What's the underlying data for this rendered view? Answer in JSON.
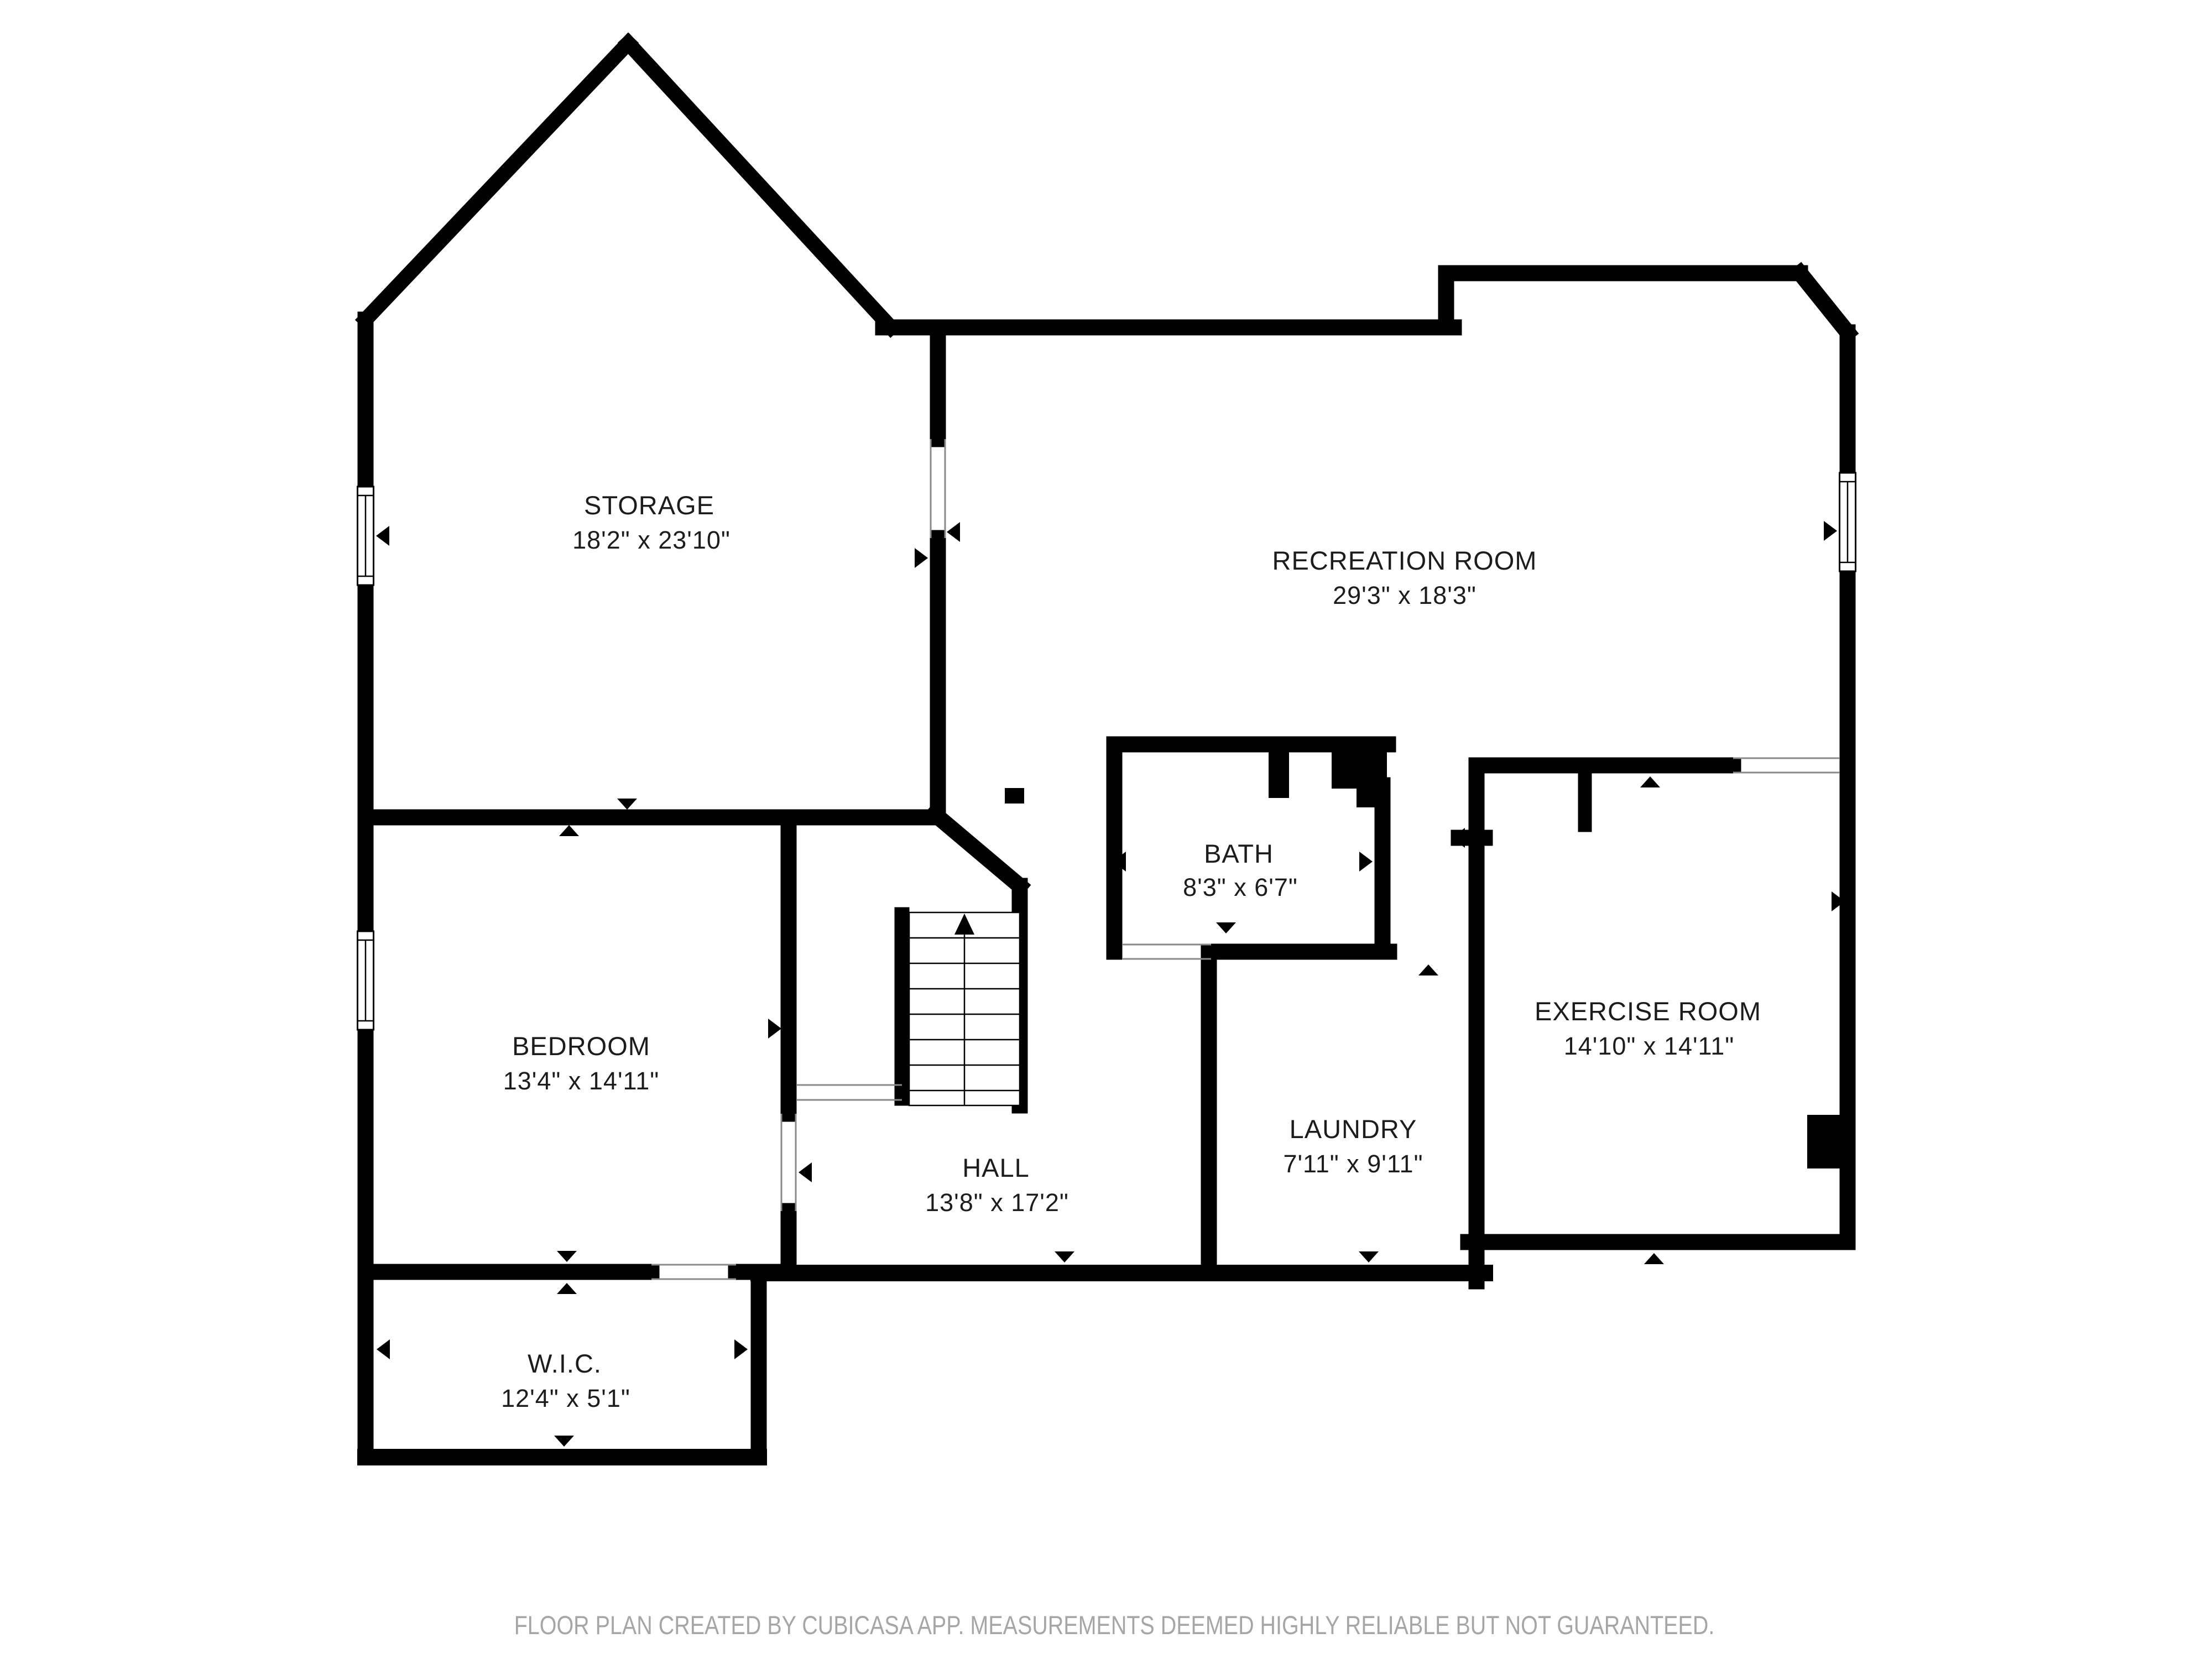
{
  "rooms": {
    "storage": {
      "name": "STORAGE",
      "dims": "18'2\" x 23'10\""
    },
    "recreation": {
      "name": "RECREATION ROOM",
      "dims": "29'3\" x 18'3\""
    },
    "bath": {
      "name": "BATH",
      "dims": "8'3\" x 6'7\""
    },
    "bedroom": {
      "name": "BEDROOM",
      "dims": "13'4\" x 14'11\""
    },
    "exercise": {
      "name": "EXERCISE ROOM",
      "dims": "14'10\" x 14'11\""
    },
    "laundry": {
      "name": "LAUNDRY",
      "dims": "7'11\" x 9'11\""
    },
    "hall": {
      "name": "HALL",
      "dims": "13'8\" x 17'2\""
    },
    "wic": {
      "name": "W.I.C.",
      "dims": "12'4\" x 5'1\""
    }
  },
  "footer": {
    "text": "FLOOR PLAN CREATED BY CUBICASA APP. MEASUREMENTS DEEMED HIGHLY RELIABLE BUT NOT GUARANTEED."
  },
  "colors": {
    "wall": "#000000",
    "label": "#1c1c1c",
    "footer_text": "#a6a6a6",
    "opening_line": "#8a8a8a"
  }
}
